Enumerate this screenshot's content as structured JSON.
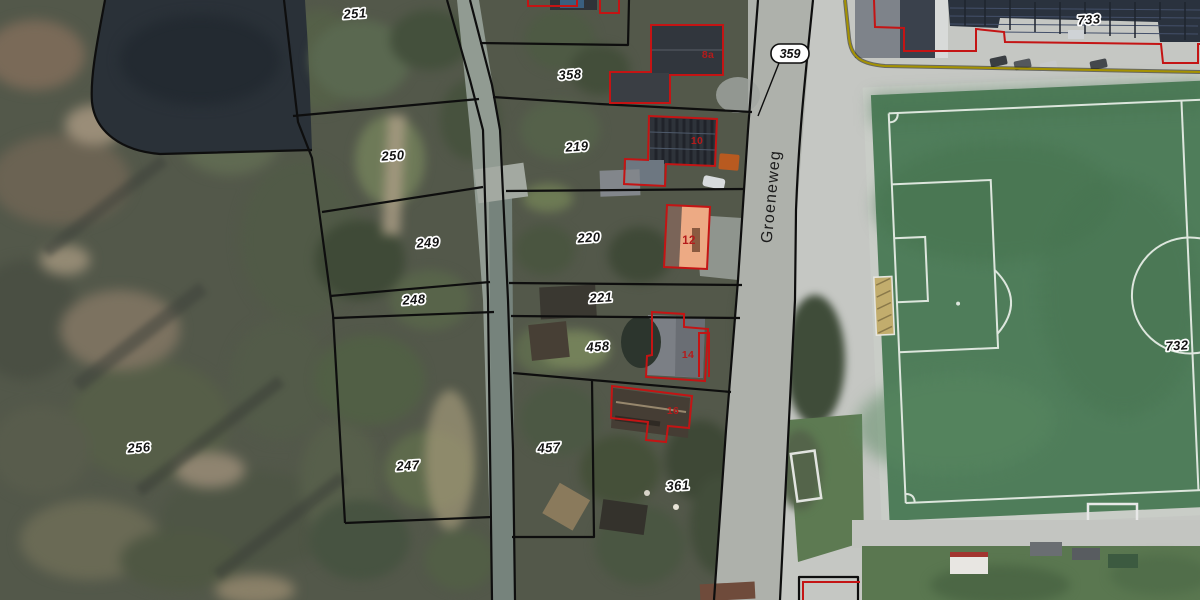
{
  "viewer": {
    "type": "cadastral-parcel-map-on-aerial-photo",
    "street": {
      "name": "Groeneweg"
    },
    "parcels": [
      {
        "label": "251",
        "x": 355,
        "y": 14
      },
      {
        "label": "358",
        "x": 570,
        "y": 75
      },
      {
        "label": "250",
        "x": 393,
        "y": 156
      },
      {
        "label": "219",
        "x": 577,
        "y": 147
      },
      {
        "label": "249",
        "x": 428,
        "y": 243
      },
      {
        "label": "220",
        "x": 589,
        "y": 238
      },
      {
        "label": "248",
        "x": 414,
        "y": 300
      },
      {
        "label": "221",
        "x": 601,
        "y": 298
      },
      {
        "label": "458",
        "x": 598,
        "y": 347
      },
      {
        "label": "256",
        "x": 139,
        "y": 448
      },
      {
        "label": "247",
        "x": 408,
        "y": 466
      },
      {
        "label": "457",
        "x": 549,
        "y": 448
      },
      {
        "label": "361",
        "x": 678,
        "y": 486
      },
      {
        "label": "732",
        "x": 1177,
        "y": 346
      },
      {
        "label": "733",
        "x": 1089,
        "y": 20
      }
    ],
    "callout": {
      "label": "359"
    },
    "houses": [
      {
        "number": "8a",
        "highlighted": false
      },
      {
        "number": "10",
        "highlighted": false
      },
      {
        "number": "12",
        "highlighted": true
      },
      {
        "number": "14",
        "highlighted": false
      },
      {
        "number": "16",
        "highlighted": false
      }
    ],
    "colors": {
      "parcel_line": "#0e0e0e",
      "building_outline": "#c41414",
      "highlight_building_fill": "#edaa84",
      "label_text": "#141414",
      "label_halo": "#ffffff",
      "house_number_text": "#b51b1b",
      "boundary_line_yellow": "#a59200",
      "field_turf": "#4f7d5a",
      "field_line": "#dde6dd",
      "road_surface": "#aeb1ab"
    }
  }
}
